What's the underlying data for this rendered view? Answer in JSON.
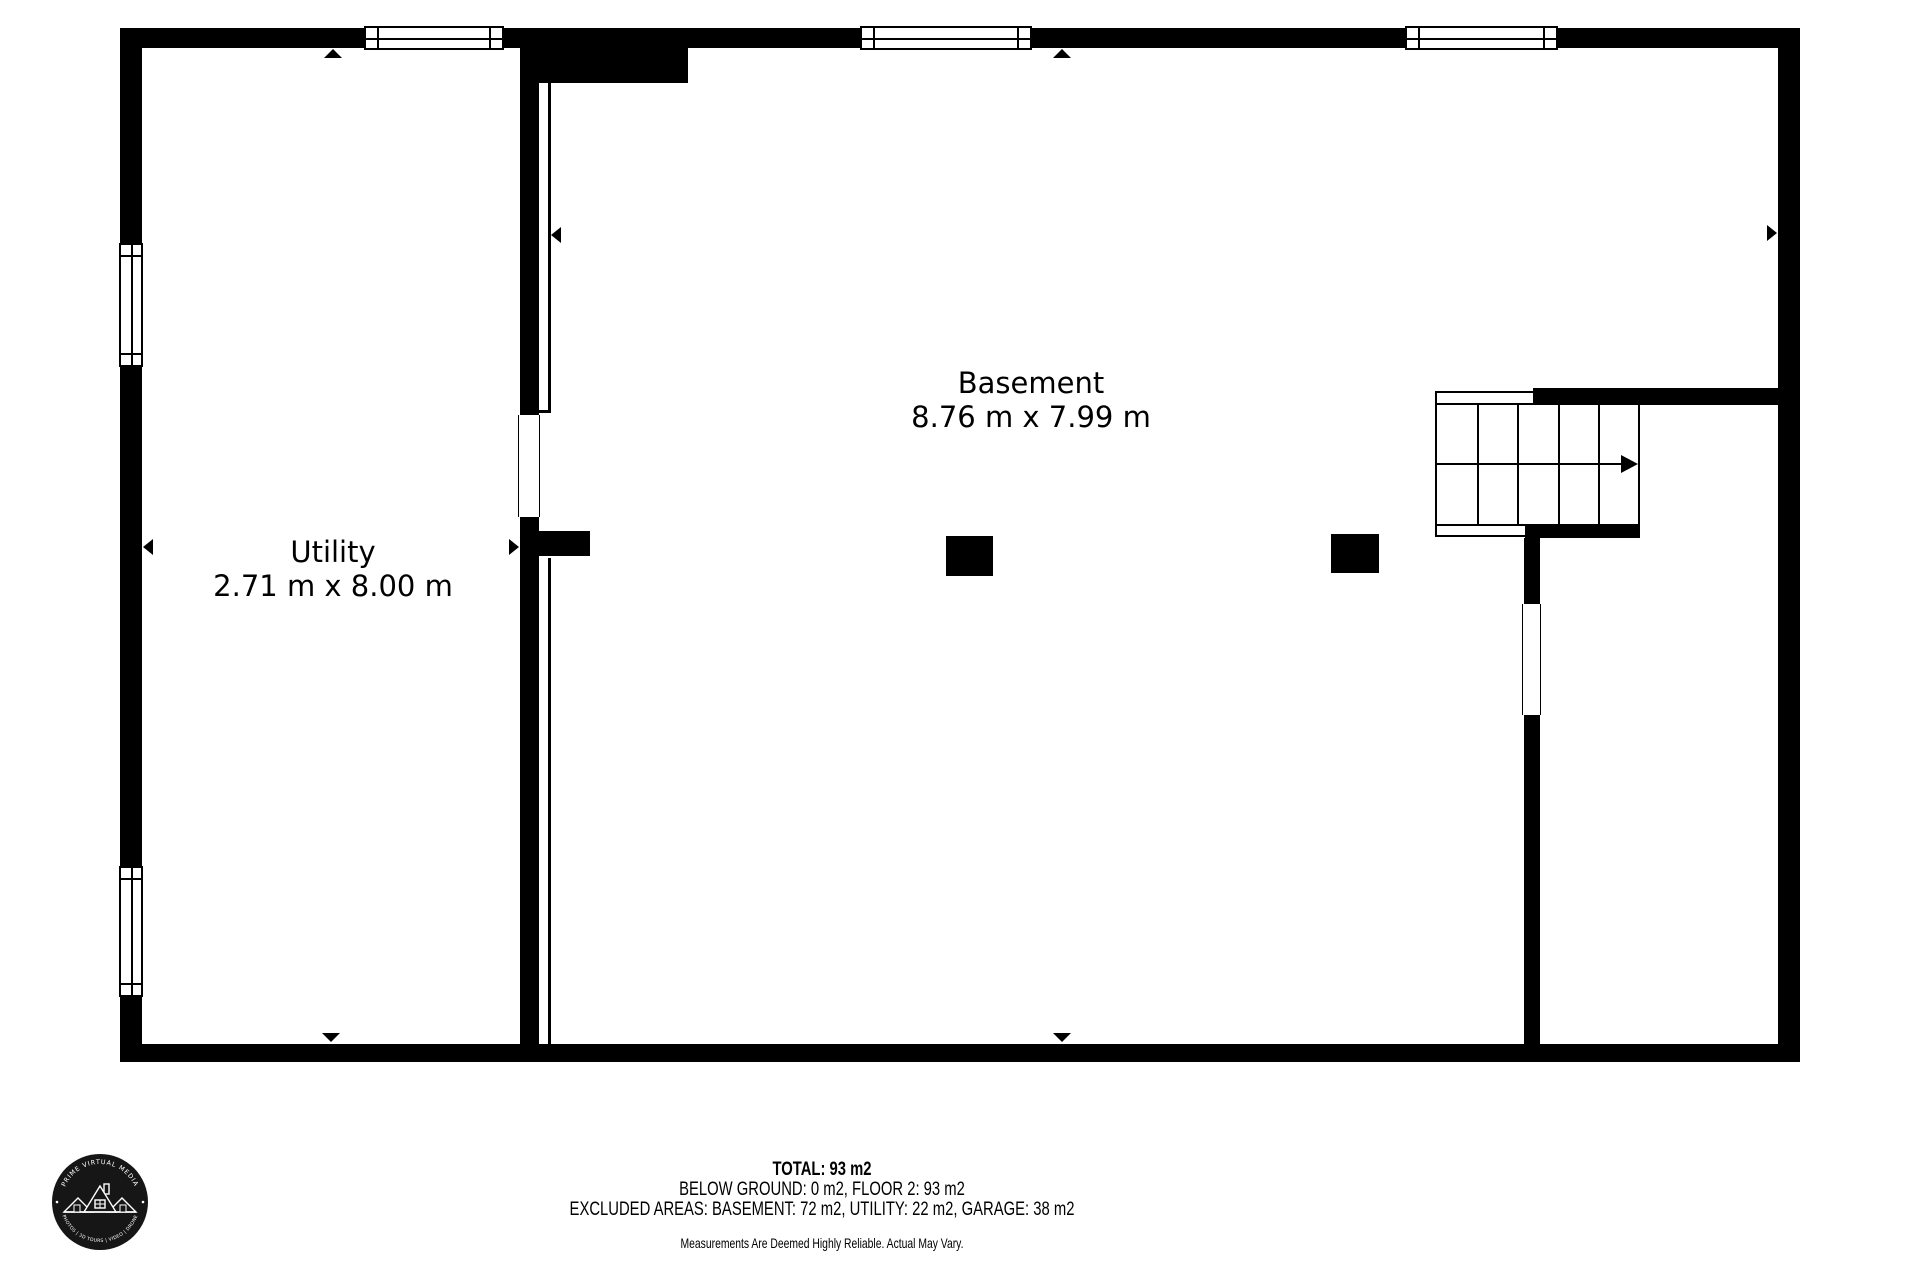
{
  "colors": {
    "wall": "#000000",
    "background": "#ffffff",
    "logo_circle": "#161616"
  },
  "rooms": [
    {
      "name": "Basement",
      "dimensions": "8.76 m x 7.99 m"
    },
    {
      "name": "Utility",
      "dimensions": "2.71 m x 8.00 m"
    }
  ],
  "footer": {
    "total": "TOTAL: 93 m2",
    "floors": "BELOW GROUND: 0 m2, FLOOR 2: 93 m2",
    "excluded": "EXCLUDED AREAS: BASEMENT: 72 m2, UTILITY: 22 m2, GARAGE: 38 m2",
    "disclaimer": "Measurements Are Deemed Highly Reliable. Actual May Vary."
  },
  "logo": {
    "top_text": "PRIME VIRTUAL MEDIA",
    "bottom_text": "PHOTOS | 3D TOURS | VIDEO | DRONE",
    "icon": "house-roofline-icon"
  }
}
